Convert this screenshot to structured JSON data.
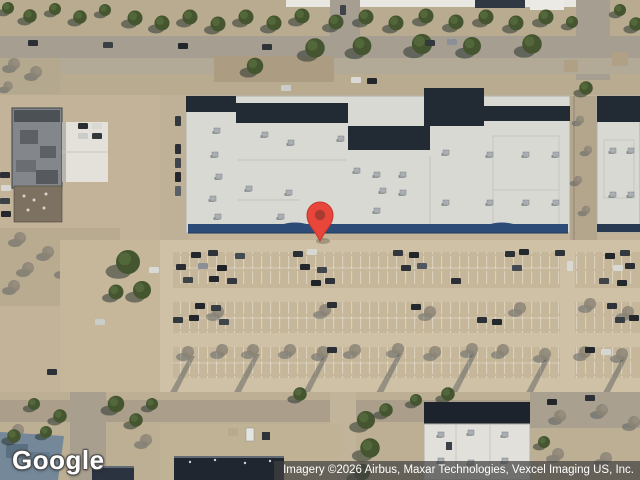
{
  "map": {
    "view": "satellite",
    "marker": {
      "name": "location-pin",
      "body_color": "#E8463B",
      "outline_color": "#C2382D",
      "dot_color": "#A93B31"
    },
    "palette": {
      "ground_tan": "#c3b499",
      "road_gray": "#a59e91",
      "roof_white": "#d9d9d4",
      "roof_dark_navy": "#222a34",
      "storefront_blue": "#2d4b77",
      "tree_green": "#44552f",
      "winter_tree": "#8a8274",
      "shadow_blue_gray": "#39424b"
    }
  },
  "watermark": {
    "logo_text": "Google"
  },
  "attribution": {
    "imagery_text": "Imagery ©2026 Airbus, Maxar Technologies, Vexcel Imaging US, Inc."
  }
}
